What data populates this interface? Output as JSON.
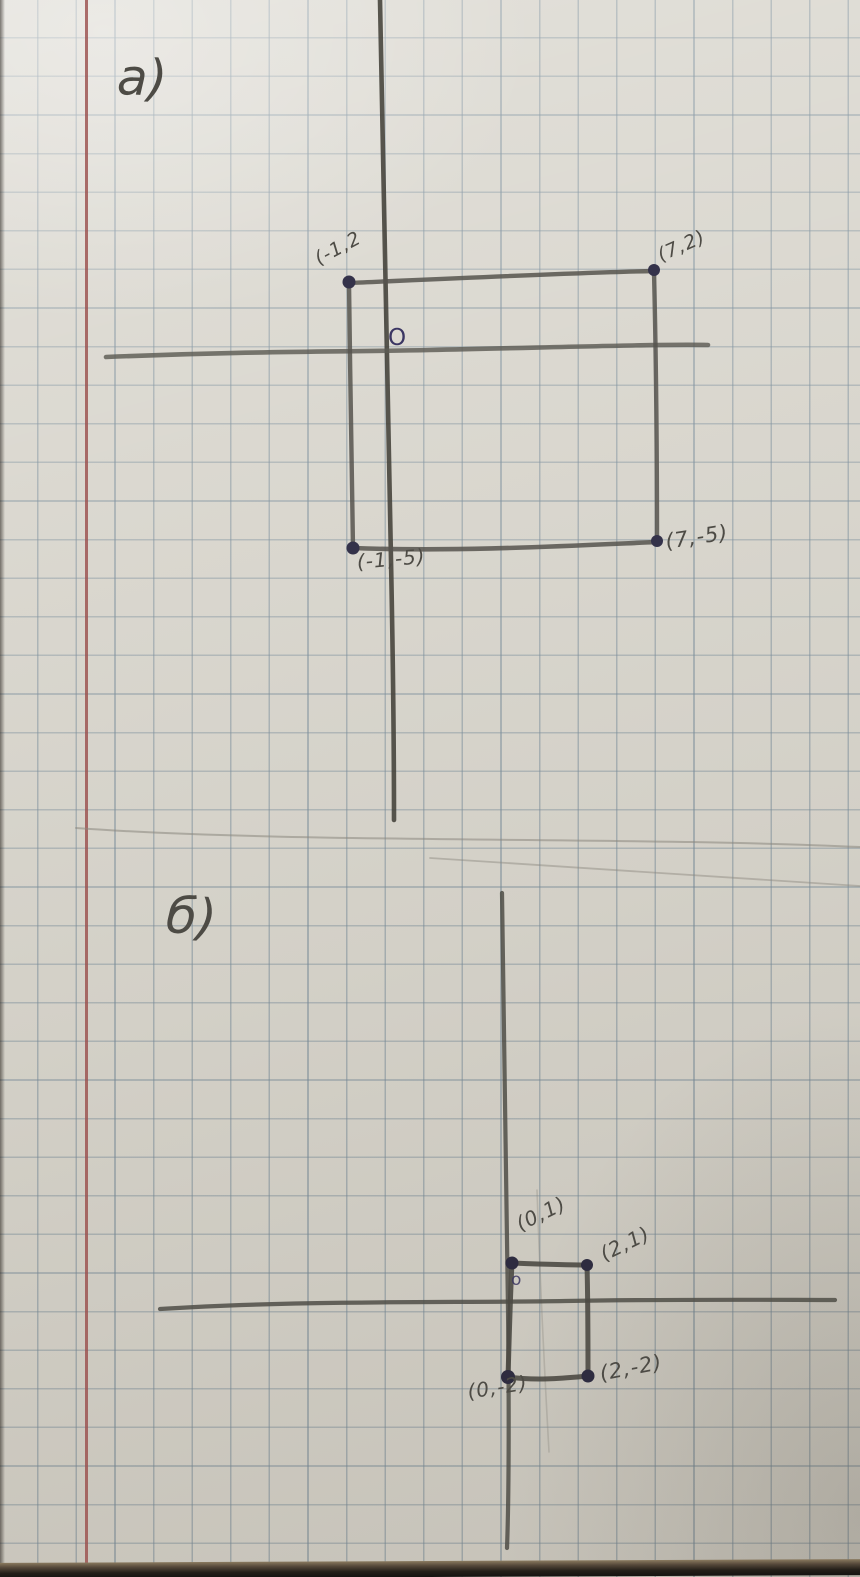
{
  "page": {
    "description": "Hand-drawn coordinate geometry exercise on squared notebook paper",
    "colors": {
      "paper": "#d7d4cb",
      "grid_line": "#768a98",
      "margin_line": "#9b504e",
      "pencil": "#52504b",
      "dot_ink": "#34324a",
      "origin_ink": "#3b3663",
      "desk_edge": "#1c1915"
    }
  },
  "sections": {
    "a": {
      "label": "a)",
      "shape": "rectangle",
      "origin_label": "O",
      "vertices": [
        {
          "text": "(-1,2",
          "point": [
            -1,
            2
          ]
        },
        {
          "text": "(7,2)",
          "point": [
            7,
            2
          ]
        },
        {
          "text": "(-1,-5)",
          "point": [
            -1,
            -5
          ]
        },
        {
          "text": "(7,-5)",
          "point": [
            7,
            -5
          ]
        }
      ]
    },
    "b": {
      "label": "б)",
      "shape": "square",
      "origin_label": "o",
      "vertices": [
        {
          "text": "(0,1)",
          "point": [
            0,
            1
          ]
        },
        {
          "text": "(2,1)",
          "point": [
            2,
            1
          ]
        },
        {
          "text": "(0,-2)",
          "point": [
            0,
            -2
          ]
        },
        {
          "text": "(2,-2)",
          "point": [
            2,
            -2
          ]
        }
      ]
    }
  }
}
